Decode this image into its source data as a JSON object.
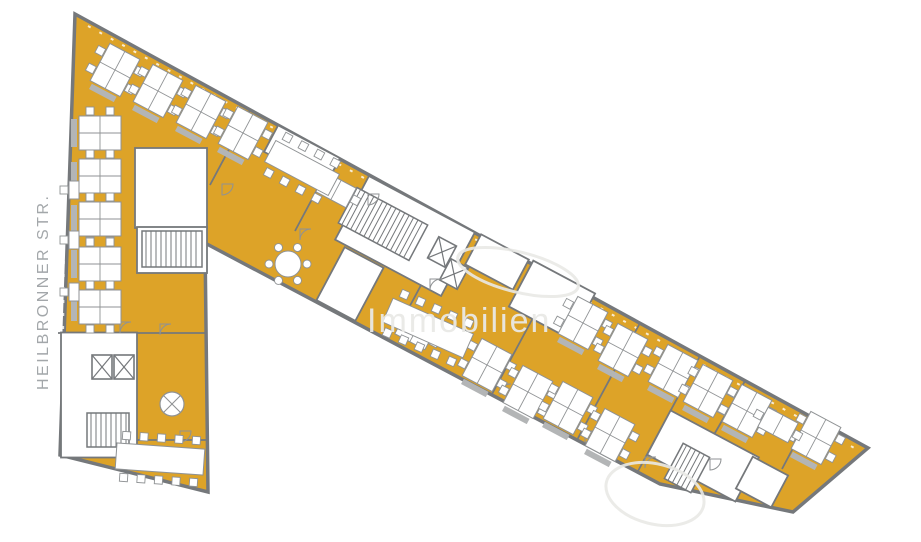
{
  "page": {
    "background": "#ffffff"
  },
  "street_label": {
    "text": "HEILBRONNER STR.",
    "color": "#a3a7aa"
  },
  "watermark": {
    "text": "Immobilien",
    "color": "#e9e9e6",
    "swooshes": [
      {
        "cx": 518,
        "cy": 272,
        "rx": 62,
        "ry": 20,
        "rot": 14
      },
      {
        "cx": 655,
        "cy": 494,
        "rx": 50,
        "ry": 30,
        "rot": 14
      }
    ]
  },
  "floorplan": {
    "floor_color": "#dda328",
    "wall_color": "#75787b",
    "furniture_fill": "#ffffff",
    "furniture_stroke": "#8f9294",
    "sideboard_color": "#b3b5b6",
    "outline": [
      [
        75,
        14
      ],
      [
        868,
        448
      ],
      [
        793,
        512
      ],
      [
        660,
        484
      ],
      [
        205,
        243
      ],
      [
        208,
        492
      ],
      [
        60,
        455
      ]
    ],
    "window_lines": [
      [
        88,
        26,
        858,
        450
      ],
      [
        66,
        40,
        62,
        440
      ]
    ],
    "partitions": [
      [
        555,
        277,
        492,
        394
      ],
      [
        640,
        323,
        577,
        440
      ],
      [
        700,
        356,
        637,
        473
      ],
      [
        745,
        381,
        682,
        490
      ],
      [
        810,
        416,
        782,
        469
      ],
      [
        250,
        110,
        210,
        185
      ],
      [
        335,
        156,
        295,
        231
      ],
      [
        58,
        333,
        207,
        333
      ],
      [
        135,
        440,
        207,
        440
      ],
      [
        455,
        222,
        405,
        315
      ]
    ],
    "white_rooms": [
      {
        "x": 171,
        "y": 188,
        "w": 72,
        "h": 80,
        "rot": 0
      },
      {
        "x": 172,
        "y": 250,
        "w": 70,
        "h": 46,
        "rot": 0
      },
      {
        "x": 99,
        "y": 395,
        "w": 76,
        "h": 125,
        "rot": 0
      },
      {
        "x": 405,
        "y": 236,
        "w": 120,
        "h": 72,
        "rot": 28
      },
      {
        "x": 302,
        "y": 155,
        "w": 70,
        "h": 30,
        "rot": 28
      },
      {
        "x": 350,
        "y": 284,
        "w": 44,
        "h": 60,
        "rot": 28
      },
      {
        "x": 497,
        "y": 262,
        "w": 54,
        "h": 34,
        "rot": 28
      },
      {
        "x": 552,
        "y": 300,
        "w": 70,
        "h": 52,
        "rot": 28
      },
      {
        "x": 703,
        "y": 456,
        "w": 100,
        "h": 50,
        "rot": 28
      },
      {
        "x": 762,
        "y": 482,
        "w": 40,
        "h": 36,
        "rot": 28
      }
    ],
    "stairs": [
      {
        "x": 172,
        "y": 249,
        "w": 60,
        "h": 36,
        "rot": 0
      },
      {
        "x": 108,
        "y": 430,
        "w": 42,
        "h": 34,
        "rot": 0
      },
      {
        "x": 383,
        "y": 224,
        "w": 80,
        "h": 40,
        "rot": 28
      },
      {
        "x": 687,
        "y": 468,
        "w": 30,
        "h": 40,
        "rot": 28
      }
    ],
    "elevators": [
      {
        "x": 102,
        "y": 367,
        "rot": 0
      },
      {
        "x": 124,
        "y": 367,
        "rot": 0
      },
      {
        "x": 442,
        "y": 252,
        "rot": 28
      },
      {
        "x": 454,
        "y": 274,
        "rot": 28
      }
    ],
    "doors": [
      [
        222,
        195
      ],
      [
        300,
        240
      ],
      [
        368,
        205
      ],
      [
        500,
        395
      ],
      [
        585,
        442
      ],
      [
        645,
        468
      ],
      [
        710,
        470
      ],
      [
        160,
        335
      ],
      [
        180,
        442
      ],
      [
        430,
        290
      ],
      [
        770,
        428
      ],
      [
        120,
        333
      ]
    ],
    "desks": [
      {
        "x": 115,
        "y": 70,
        "rot": 28,
        "type": "quad"
      },
      {
        "x": 158,
        "y": 91,
        "rot": 28,
        "type": "quad"
      },
      {
        "x": 201,
        "y": 112,
        "rot": 28,
        "type": "quad"
      },
      {
        "x": 243,
        "y": 133,
        "rot": 28,
        "type": "quad"
      },
      {
        "x": 100,
        "y": 133,
        "rot": 90,
        "type": "quad"
      },
      {
        "x": 100,
        "y": 176,
        "rot": 90,
        "type": "quad"
      },
      {
        "x": 100,
        "y": 219,
        "rot": 90,
        "type": "quad"
      },
      {
        "x": 100,
        "y": 264,
        "rot": 90,
        "type": "quad"
      },
      {
        "x": 100,
        "y": 307,
        "rot": 90,
        "type": "quad"
      },
      {
        "x": 74,
        "y": 190,
        "rot": 90,
        "type": "solo"
      },
      {
        "x": 74,
        "y": 240,
        "rot": 90,
        "type": "solo"
      },
      {
        "x": 74,
        "y": 292,
        "rot": 90,
        "type": "solo"
      },
      {
        "x": 336,
        "y": 190,
        "rot": 28,
        "type": "duo"
      },
      {
        "x": 415,
        "y": 332,
        "rot": 28,
        "type": "duo"
      },
      {
        "x": 487,
        "y": 365,
        "rot": 28,
        "type": "quad"
      },
      {
        "x": 528,
        "y": 392,
        "rot": 28,
        "type": "quad"
      },
      {
        "x": 568,
        "y": 408,
        "rot": 28,
        "type": "quad"
      },
      {
        "x": 610,
        "y": 435,
        "rot": 28,
        "type": "quad"
      },
      {
        "x": 583,
        "y": 323,
        "rot": 28,
        "type": "quad"
      },
      {
        "x": 623,
        "y": 350,
        "rot": 28,
        "type": "quad"
      },
      {
        "x": 673,
        "y": 371,
        "rot": 28,
        "type": "quad"
      },
      {
        "x": 708,
        "y": 391,
        "rot": 28,
        "type": "quad"
      },
      {
        "x": 747,
        "y": 411,
        "rot": 28,
        "type": "quad"
      },
      {
        "x": 816,
        "y": 438,
        "rot": 28,
        "type": "quad"
      },
      {
        "x": 778,
        "y": 425,
        "rot": 28,
        "type": "duo"
      }
    ],
    "tables": [
      {
        "x": 302,
        "y": 168,
        "rot": 28,
        "type": "conf8"
      },
      {
        "x": 428,
        "y": 328,
        "rot": 24,
        "type": "conf10"
      },
      {
        "x": 160,
        "y": 459,
        "rot": 4,
        "type": "conf10"
      },
      {
        "x": 288,
        "y": 264,
        "rot": 0,
        "type": "round6"
      },
      {
        "x": 172,
        "y": 404,
        "rot": 0,
        "type": "roundX"
      }
    ]
  }
}
